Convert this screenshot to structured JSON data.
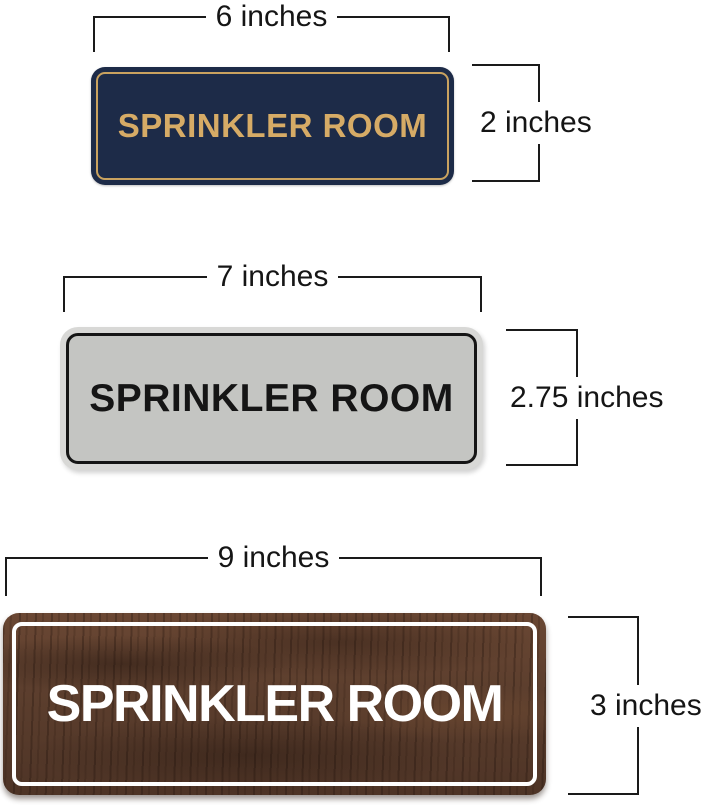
{
  "diagram": {
    "description": "Dimension diagram of three SPRINKLER ROOM door signs in different sizes and finishes",
    "dimension_line_color": "#1a1a1a",
    "background_color": "#ffffff"
  },
  "signs": [
    {
      "finish": "navy-gold",
      "text": "SPRINKLER ROOM",
      "width_label": "6 inches",
      "height_label": "2 inches",
      "colors": {
        "plate": "#1d2b48",
        "text": "#d6ab66",
        "border": "#c9a25f"
      }
    },
    {
      "finish": "silver-black",
      "text": "SPRINKLER ROOM",
      "width_label": "7 inches",
      "height_label": "2.75 inches",
      "colors": {
        "frame": "#d8d8d6",
        "plate": "#c4c5c2",
        "text": "#151515",
        "border": "#151515"
      }
    },
    {
      "finish": "walnut-wood-white",
      "text": "SPRINKLER ROOM",
      "width_label": "9 inches",
      "height_label": "3 inches",
      "colors": {
        "plate": "#573a2b",
        "text": "#ffffff",
        "border": "#ffffff"
      }
    }
  ]
}
